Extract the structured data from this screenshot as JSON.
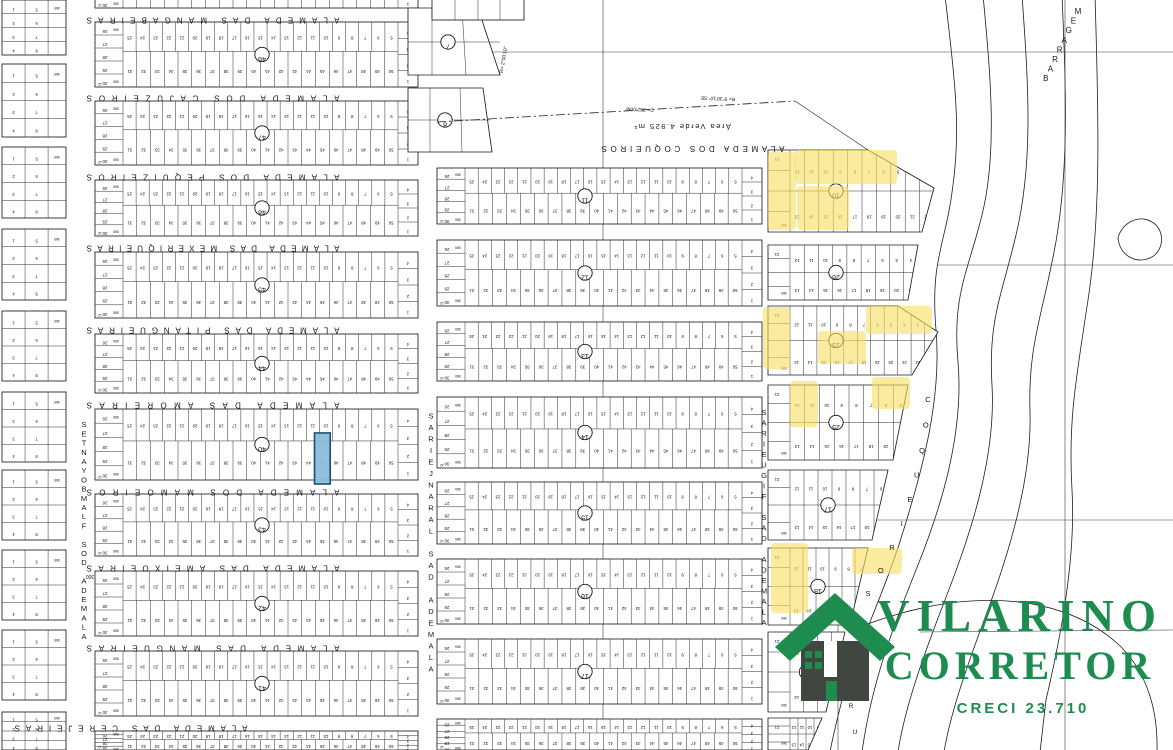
{
  "title": "Planta de loteamento - Vilarino Corretor",
  "map": {
    "streets_horizontal": [
      {
        "name": "ALAMEDA DAS MANGABEIRAS"
      },
      {
        "name": "ALAMEDA DOS CAJUZEIROS"
      },
      {
        "name": "ALAMEDA DOS PEQUIZEIROS"
      },
      {
        "name": "ALAMEDA DAS MEXERIQUEIRAS"
      },
      {
        "name": "ALAMEDA DAS PITANGUEIRAS"
      },
      {
        "name": "ALAMEDA DAS AMOREIRAS"
      },
      {
        "name": "ALAMEDA DOS MAMOEIROS"
      },
      {
        "name": "ALAMEDA DAS AMEIXOEIRAS"
      },
      {
        "name": "ALAMEDA DAS MANGUEIRAS"
      },
      {
        "name": "ALAMEDA DAS CEREJEIRAS"
      }
    ],
    "street_coqueiros_top": "ALAMEDA DOS COQUEIROS",
    "streets_vertical": [
      {
        "name": "ALAMEDA DOS FLAMBOYANTES"
      },
      {
        "name": "ALAMEDA DAS LARANJEIRAS"
      },
      {
        "name": "ALAMEDA DAS FIGUEIRAS"
      },
      {
        "name": "COQUEIROS"
      }
    ],
    "water_label": "BARRAGEM",
    "rua_partial_label": "RU",
    "annotations": {
      "area_verde": "Área Verde 4.925 m²",
      "bearing1": "R= 5°30'10\" SE",
      "dist1": "D= 352,00M",
      "bearing2": "R= 2°00'10\"",
      "num300": "300",
      "lot_depth": "360",
      "lot_front": "12"
    },
    "block_numbers": {
      "left_column": [
        "46",
        "47",
        "48",
        "45",
        "44",
        "40",
        "43",
        "42",
        "41"
      ],
      "center_top": [
        "7",
        "8"
      ],
      "center_column": [
        "11",
        "12",
        "13",
        "14",
        "15",
        "16",
        "17"
      ],
      "right_column": [
        "10",
        "26",
        "15",
        "25",
        "17",
        "18",
        "24"
      ]
    },
    "lot_numbering": {
      "head_cells": [
        "26",
        "27",
        "28",
        "29",
        "30"
      ],
      "end_cells": [
        "4",
        "3",
        "2",
        "1"
      ],
      "top_row_start": 25,
      "bottom_row_start": 31,
      "right_block_top_start": 12,
      "right_block_bottom_start": 13,
      "mini_block_cells": [
        "1",
        "2",
        "3",
        "4",
        "5",
        "6",
        "7",
        "8"
      ]
    },
    "highlights": {
      "blue_lot": {
        "block": "40",
        "lot": "45"
      },
      "yellow_lots": [
        {
          "block": "10",
          "lots": "5-11 e 13, 19-21"
        },
        {
          "block": "15",
          "lots": "13-16, 22-24 e lotes de esquina"
        },
        {
          "block": "25",
          "lots": "6, 8, 9, 20, 21"
        },
        {
          "block": "18",
          "lots": "9-13, 15"
        }
      ],
      "yellow_color": "#f7de62",
      "blue_color": "#85bcdc"
    }
  },
  "logo": {
    "line1": "VILARINO",
    "line2": "CORRETOR",
    "creci": "CRECI 23.710",
    "green": "#1e8c4f",
    "dark": "#414641"
  }
}
